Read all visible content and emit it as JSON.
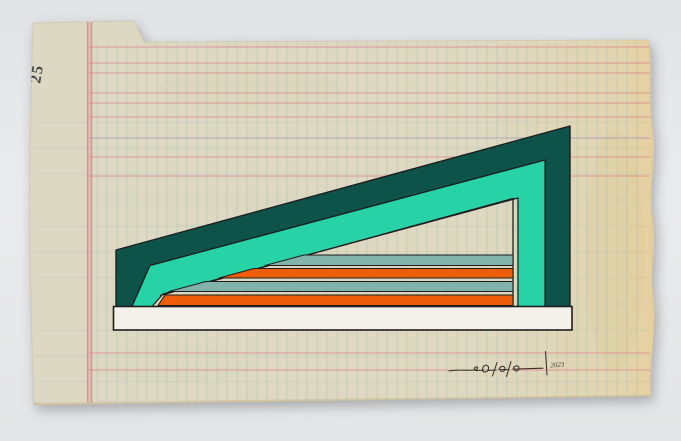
{
  "scene": {
    "background_color": "#e6e8e9"
  },
  "paper": {
    "page_number": "25",
    "base_color": "#ddd8c3",
    "mid_color": "#ded8c1",
    "edge_tint": "#e6d0a0",
    "grid": {
      "teal_line_color": "#9fc3b4",
      "pink_line_color": "#e0808b",
      "purple_line_color": "#9e92bb",
      "vertical": {
        "start": 97,
        "end": 645,
        "step": 10,
        "y1": 43,
        "y2": 403,
        "opacity": 0.5
      },
      "horizontal_teal": {
        "start": 122,
        "end": 395,
        "step": 26,
        "x1": 34,
        "x2": 650,
        "opacity": 0.38
      },
      "pink_horizontal_ys": [
        47,
        63,
        73,
        93,
        103,
        117,
        157,
        176,
        353,
        370
      ],
      "pink_x1": 89,
      "pink_x2": 650,
      "purple_horizontal_y": 138,
      "margin_band_x": 89.6,
      "margin_vertical_xs": [
        87.6,
        91.6
      ]
    }
  },
  "artwork": {
    "palette": {
      "dark_teal": "#0e5349",
      "turquoise": "#27d3a6",
      "gray_teal": "#82b3aa",
      "orange": "#ee5e0a",
      "white_bar": "#f3f1ea",
      "outline": "#1e1e1e",
      "signature_ink": "#38322b"
    },
    "signature_year": "2023"
  }
}
